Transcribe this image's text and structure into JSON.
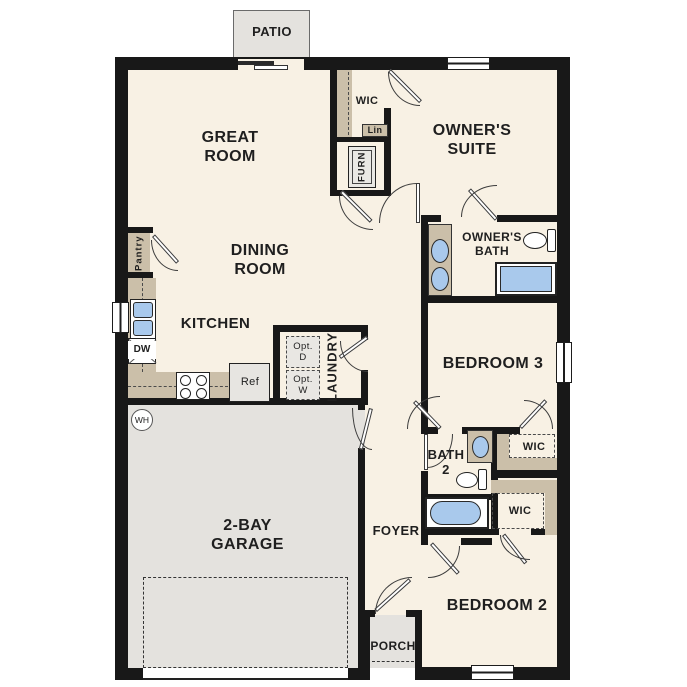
{
  "plan": {
    "title": "Single-story 3-bedroom floor plan",
    "colors": {
      "background": "#ffffff",
      "wall": "#181818",
      "floor": "#f8f1e4",
      "concrete": "#e4e2de",
      "cabinetry": "#cbbfa9",
      "fixture_blue": "#a9c9ec",
      "text": "#1f1f1f"
    },
    "labels": {
      "patio": "PATIO",
      "great_room_1": "GREAT",
      "great_room_2": "ROOM",
      "wic_owner": "WIC",
      "lin": "Lin",
      "furn": "FURN",
      "owners_suite_1": "OWNER'S",
      "owners_suite_2": "SUITE",
      "pantry": "Pantry",
      "dining_1": "DINING",
      "dining_2": "ROOM",
      "owners_bath_1": "OWNER'S",
      "owners_bath_2": "BATH",
      "kitchen": "KITCHEN",
      "dw": "DW",
      "ref": "Ref",
      "opt_d_1": "Opt.",
      "opt_d_2": "D",
      "opt_w_1": "Opt.",
      "opt_w_2": "W",
      "laundry": "LAUNDRY",
      "bedroom3": "BEDROOM 3",
      "wh": "WH",
      "garage_1": "2-BAY",
      "garage_2": "GARAGE",
      "foyer": "FOYER",
      "bath2_1": "BATH",
      "bath2_2": "2",
      "wic_bed3": "WIC",
      "wic_bed2": "WIC",
      "porch": "PORCH",
      "bedroom2": "BEDROOM 2"
    }
  }
}
